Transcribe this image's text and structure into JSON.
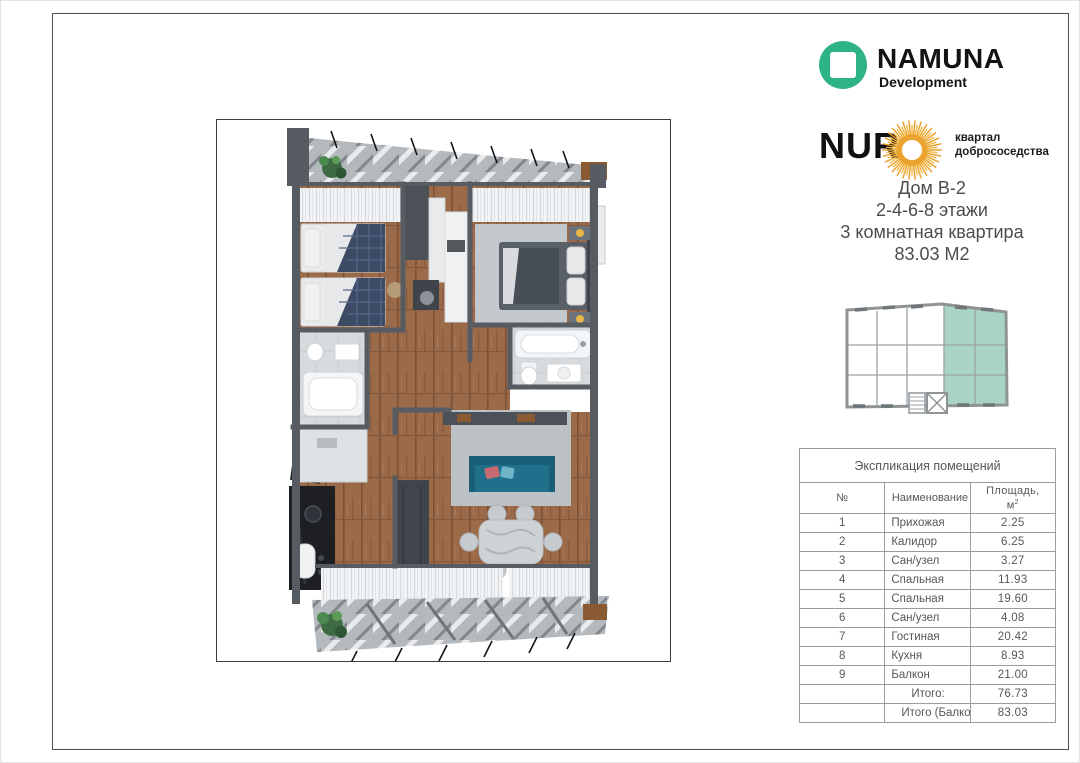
{
  "brand": {
    "namuna": {
      "name": "NAMUNA",
      "subtitle": "Development",
      "logo_color": "#2EB385"
    },
    "nur": {
      "name": "NUR",
      "tagline_line1": "квартал",
      "tagline_line2": "добрососедства",
      "sun_color": "#EBA32F"
    }
  },
  "apartment": {
    "house": "Дом В-2",
    "floors": "2-4-6-8 этажи",
    "type": "3 комнатная квартира",
    "area": "83.03 М2"
  },
  "diagram": {
    "highlight_color": "#A9D4C4",
    "outline_color": "#8E9496"
  },
  "table": {
    "title": "Экспликация помещений",
    "columns": {
      "num": "№",
      "name": "Наименование",
      "area_line1": "Площадь,",
      "area_base": "м",
      "area_sup": "2"
    },
    "rows": [
      {
        "num": "1",
        "name": "Прихожая",
        "area": "2.25"
      },
      {
        "num": "2",
        "name": "Калидор",
        "area": "6.25"
      },
      {
        "num": "3",
        "name": "Сан/узел",
        "area": "3.27"
      },
      {
        "num": "4",
        "name": "Спальная",
        "area": "11.93"
      },
      {
        "num": "5",
        "name": "Спальная",
        "area": "19.60"
      },
      {
        "num": "6",
        "name": "Сан/узел",
        "area": "4.08"
      },
      {
        "num": "7",
        "name": "Гостиная",
        "area": "20.42"
      },
      {
        "num": "8",
        "name": "Кухня",
        "area": "8.93"
      },
      {
        "num": "9",
        "name": "Балкон",
        "area": "21.00"
      }
    ],
    "total": {
      "label": "Итого:",
      "value": "76.73"
    },
    "total_with_balcony": {
      "label": "Итого  (Балкон 30%)",
      "value": "83.03"
    }
  }
}
